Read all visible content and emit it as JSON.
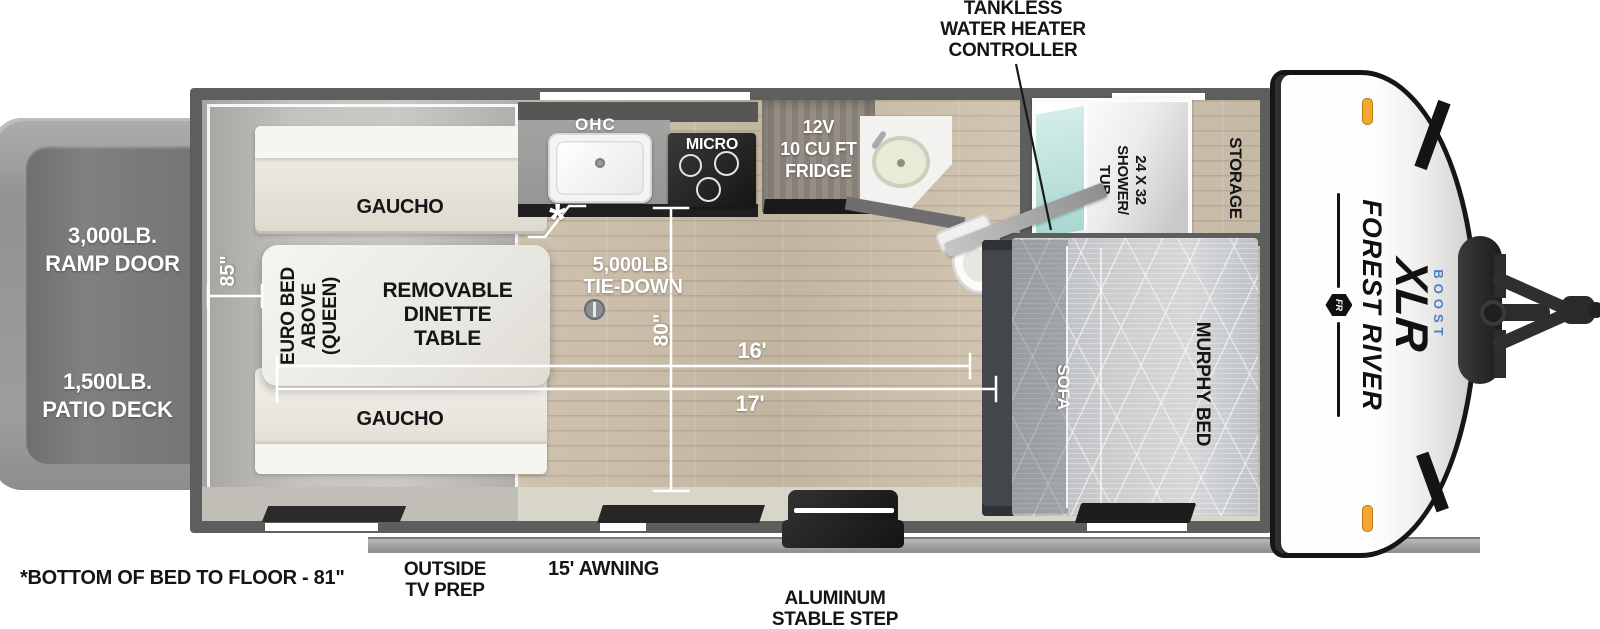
{
  "callouts": {
    "tankless": [
      "TANKLESS",
      "WATER HEATER",
      "CONTROLLER"
    ],
    "bed_note": "*BOTTOM OF BED TO FLOOR - 81\"",
    "outside_tv": [
      "OUTSIDE",
      "TV PREP"
    ],
    "awning": "15' AWNING",
    "step": [
      "ALUMINUM",
      "STABLE STEP"
    ],
    "asterisk": "*"
  },
  "exterior": {
    "ramp_door": [
      "3,000LB.",
      "RAMP DOOR"
    ],
    "patio_deck": [
      "1,500LB.",
      "PATIO DECK"
    ]
  },
  "interior": {
    "gaucho_top": "GAUCHO",
    "gaucho_bottom": "GAUCHO",
    "euro_bed": [
      "EURO BED",
      "ABOVE",
      "(QUEEN)"
    ],
    "dinette": [
      "REMOVABLE",
      "DINETTE",
      "TABLE"
    ],
    "ohc": "OHC",
    "micro": "MICRO",
    "fridge": [
      "12V",
      "10 CU FT",
      "FRIDGE"
    ],
    "tie_down": [
      "5,000LB.",
      "TIE-DOWN"
    ],
    "shower": [
      "24 X 32",
      "SHOWER/",
      "TUB"
    ],
    "storage": "STORAGE",
    "sofa": "SOFA",
    "murphy_bed": "MURPHY BED"
  },
  "dimensions": {
    "cargo_width": "85\"",
    "interior_width": "80\"",
    "floor_length": "16'",
    "total_length": "17'"
  },
  "brand": {
    "maker": "FOREST RIVER",
    "model": "XLR",
    "trim": "BOOST",
    "logo": "FR"
  },
  "colors": {
    "boost_blue": "#4a7fc1",
    "marker_orange": "#f5a733",
    "wall_gray": "#5d5e5e"
  }
}
